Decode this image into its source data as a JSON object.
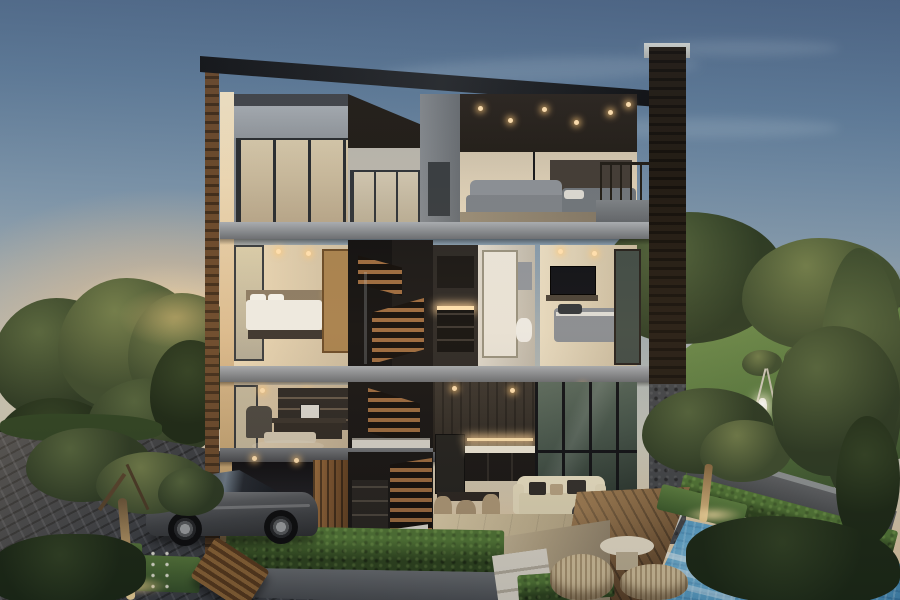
{
  "scene": {
    "title": "Dusk architectural rendering: cutaway three-storey modern house with carport, pool and garden",
    "labels": {
      "sky": "dusk sky with sun glow",
      "house": "three-storey cutaway house",
      "roof": "black mono-pitch roof",
      "top_bedroom": "top-floor bedroom with downlights",
      "middle_bedroom": "second-floor bedroom",
      "bathroom": "second-floor bathroom",
      "tv_bedroom": "second-floor bedroom with TV",
      "staircase": "central timber staircase",
      "office": "ground-floor study",
      "living_room": "double-height living and dining space",
      "kitchen": "kitchen with lit counter",
      "carport": "basement carport",
      "car": "grey car parked on driveway",
      "driveway": "dark brick driveway",
      "hedge": "clipped box hedges",
      "pool": "mosaic-tiled swimming pool",
      "deck": "timber pool deck",
      "lawn": "back lawn with staked saplings",
      "trees": "garden trees",
      "bench": "timber bench",
      "wicker_set": "wicker ottomans and side table"
    },
    "palette": {
      "sky_top": "#4d6585",
      "sky_mid": "#7e95a9",
      "sky_pale": "#c6c7bb",
      "sky_horizon": "#eed9b2",
      "sun": "#ffedc8",
      "roof": "#141517",
      "frame_light": "#9a9ea2",
      "frame_dark": "#64676b",
      "wall_warm": "#e3d5ba",
      "wall_lit": "#f2e3c4",
      "ceiling_dark": "#25201a",
      "wood_stair": "#9c6b3f",
      "wood_door": "#7d5530",
      "wood_slat": "#6b4a2c",
      "glass_cool": "#c9c2ad",
      "glass_green": "#44544a",
      "light_warm": "#ffd9a2",
      "tree_dark": "#2c3a23",
      "tree_mid": "#3d4c2e",
      "lawn": "#58793f",
      "hedge": "#3c5a28",
      "driveway": "#3b3e43",
      "deck": "#7a5a38",
      "pool_deep": "#3f85b0",
      "pool_light": "#bfe6f7",
      "coping": "#d8dbd6",
      "stone": "#8e9394",
      "car_body": "#55585c",
      "wicker": "#d3c19c",
      "bench": "#8a6336",
      "trunk_lit": "#dbb97e"
    }
  }
}
